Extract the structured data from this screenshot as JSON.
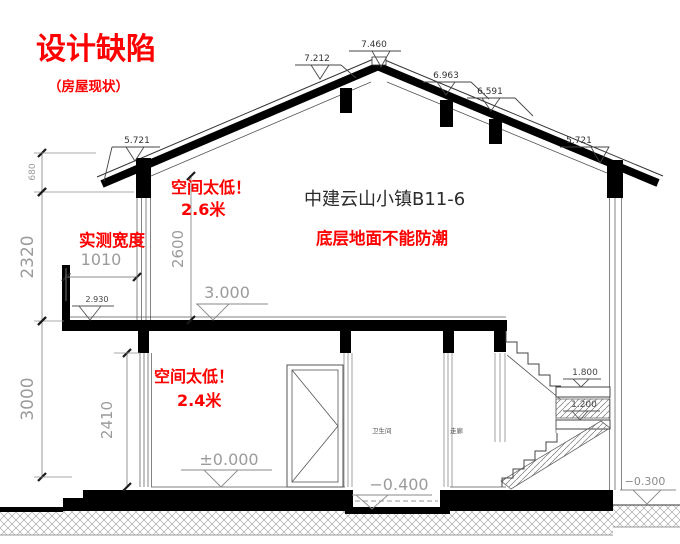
{
  "titles": {
    "main": "设计缺陷",
    "sub": "（房屋现状）",
    "building": "中建云山小镇B11-6"
  },
  "notes": {
    "low_upper_1": "空间太低！",
    "low_upper_2": "2.6米",
    "width_note": "实测宽度",
    "floor_note": "底层地面不能防潮",
    "low_lower_1": "空间太低！",
    "low_lower_2": "2.4米"
  },
  "rooms": {
    "bathroom": "卫生间",
    "corridor": "走廊"
  },
  "colors": {
    "annotation_red": "#ff0000",
    "heavy_line": "#000000",
    "dim_gray": "#9b9b9b"
  },
  "levels": [
    {
      "id": "roof-left-7212",
      "value": "7.212",
      "lx1": 295,
      "lx2": 341,
      "ly": 65,
      "tx": 320,
      "ty": 79,
      "tw": 9,
      "leader": [
        341,
        65,
        356,
        78
      ],
      "textX": 317,
      "textY": 61,
      "fs": 9,
      "lc": "#444",
      "tc": "#333"
    },
    {
      "id": "ridge-7460",
      "value": "7.460",
      "lx1": 349,
      "lx2": 401,
      "ly": 51,
      "tx": 381,
      "ty": 67,
      "tw": 9,
      "textX": 374,
      "textY": 47,
      "fs": 9,
      "lc": "#444",
      "tc": "#333"
    },
    {
      "id": "roof-right-6963",
      "value": "6.963",
      "lx1": 423,
      "lx2": 471,
      "ly": 82,
      "tx": 446,
      "ty": 95,
      "tw": 9,
      "leader": [
        471,
        82,
        489,
        99
      ],
      "textX": 446,
      "textY": 78,
      "fs": 9,
      "lc": "#444",
      "tc": "#333"
    },
    {
      "id": "roof-right-6591",
      "value": "6.591",
      "lx1": 467,
      "lx2": 515,
      "ly": 98,
      "tx": 491,
      "ty": 111,
      "tw": 9,
      "leader": [
        515,
        98,
        533,
        116
      ],
      "textX": 490,
      "textY": 94,
      "fs": 9,
      "lc": "#444",
      "tc": "#333"
    },
    {
      "id": "eave-left-5721",
      "value": "5.721",
      "lx1": 112,
      "lx2": 160,
      "ly": 147,
      "tx": 135,
      "ty": 161,
      "tw": 9,
      "leader": [
        112,
        147,
        104,
        181
      ],
      "textX": 137,
      "textY": 143,
      "fs": 9,
      "lc": "#444",
      "tc": "#333"
    },
    {
      "id": "eave-right-5721",
      "value": "5.721",
      "lx1": 560,
      "lx2": 604,
      "ly": 147,
      "tx": 600,
      "ty": 163,
      "tw": 9,
      "textX": 579,
      "textY": 143,
      "fs": 9,
      "lc": "#444",
      "tc": "#333"
    },
    {
      "id": "balcony-2930",
      "value": "2.930",
      "lx1": 72,
      "lx2": 114,
      "ly": 306,
      "tx": 90,
      "ty": 320,
      "tw": 11,
      "textX": 97,
      "textY": 302,
      "fs": 8,
      "lc": "#555",
      "tc": "#444"
    },
    {
      "id": "floor2-3000",
      "value": "3.000",
      "lx1": 196,
      "lx2": 268,
      "ly": 304,
      "tx": 213,
      "ty": 320,
      "tw": 16,
      "textX": 227,
      "textY": 298,
      "fs": 16,
      "lc": "#888",
      "tc": "#9b9b9b"
    },
    {
      "id": "stair-landing-1800",
      "value": "1.800",
      "lx1": 563,
      "lx2": 601,
      "ly": 379,
      "tx": 581,
      "ty": 387,
      "tw": 8,
      "textX": 585,
      "textY": 375,
      "fs": 9,
      "lc": "#555",
      "tc": "#444"
    },
    {
      "id": "stair-landing-1200",
      "value": "1.200",
      "lx1": 563,
      "lx2": 600,
      "ly": 411,
      "tx": 580,
      "ty": 420,
      "tw": 8,
      "textX": 584,
      "textY": 407,
      "fs": 9,
      "lc": "#555",
      "tc": "#444"
    },
    {
      "id": "floor1-zero",
      "value": "±0.000",
      "lx1": 181,
      "lx2": 272,
      "ly": 470,
      "tx": 221,
      "ty": 487,
      "tw": 17,
      "textX": 229,
      "textY": 465,
      "fs": 16,
      "lc": "#888",
      "tc": "#9b9b9b"
    },
    {
      "id": "pit-minus-0400",
      "value": "−0.400",
      "lx1": 352,
      "lx2": 432,
      "ly": 495,
      "tx": 372,
      "ty": 509,
      "tw": 16,
      "textX": 399,
      "textY": 490,
      "fs": 16,
      "lc": "#888",
      "tc": "#9b9b9b"
    },
    {
      "id": "ground-right-minus-0300",
      "value": "−0.300",
      "lx1": 620,
      "lx2": 676,
      "ly": 490,
      "tx": 647,
      "ty": 504,
      "tw": 14,
      "textX": 645,
      "textY": 485,
      "fs": 11,
      "lc": "#888",
      "tc": "#8a8a8a"
    }
  ],
  "dimensions": [
    {
      "id": "left-680",
      "value": "680",
      "x1": 42,
      "y1": 153,
      "x2": 42,
      "y2": 192,
      "rot": true,
      "tx": 35,
      "ty": 172,
      "fs": 9,
      "ext": [
        [
          34,
          153,
          96,
          153
        ],
        [
          34,
          192,
          134,
          192
        ]
      ]
    },
    {
      "id": "left-2320",
      "value": "2320",
      "x1": 42,
      "y1": 192,
      "x2": 42,
      "y2": 321,
      "rot": true,
      "tx": 33,
      "ty": 257,
      "fs": 17,
      "ext": [
        [
          34,
          321,
          64,
          321
        ]
      ]
    },
    {
      "id": "left-3000",
      "value": "3000",
      "x1": 42,
      "y1": 321,
      "x2": 42,
      "y2": 477,
      "rot": true,
      "tx": 33,
      "ty": 399,
      "fs": 17,
      "ext": [
        [
          34,
          477,
          72,
          477
        ]
      ]
    },
    {
      "id": "upper-room-2600",
      "value": "2600",
      "x1": 191,
      "y1": 176,
      "x2": 191,
      "y2": 320,
      "rot": true,
      "tx": 183,
      "ty": 249,
      "fs": 15,
      "ext": []
    },
    {
      "id": "lower-room-2410",
      "value": "2410",
      "x1": 127,
      "y1": 353,
      "x2": 127,
      "y2": 487,
      "rot": true,
      "tx": 112,
      "ty": 420,
      "fs": 15,
      "ext": [
        [
          114,
          353,
          140,
          353
        ]
      ]
    },
    {
      "id": "balcony-1010",
      "value": "1010",
      "x1": 66,
      "y1": 277,
      "x2": 137,
      "y2": 277,
      "rot": false,
      "tx": 101,
      "ty": 265,
      "fs": 16,
      "ext": [
        [
          66,
          268,
          66,
          301
        ],
        [
          137,
          268,
          137,
          291
        ]
      ]
    }
  ]
}
